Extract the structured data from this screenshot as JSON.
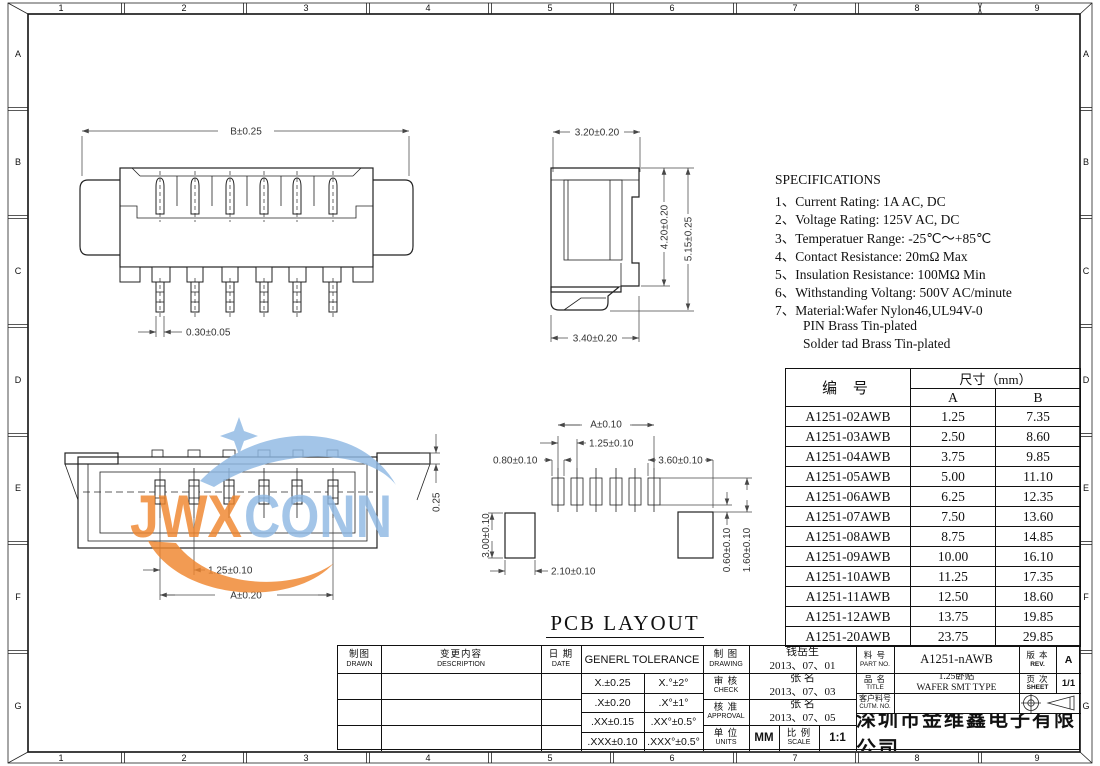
{
  "frame": {
    "top_zones": [
      "1",
      "2",
      "3",
      "4",
      "5",
      "6",
      "7",
      "8",
      "9"
    ],
    "bottom_zones": [
      "1",
      "2",
      "3",
      "4",
      "5",
      "6",
      "7",
      "8",
      "9"
    ],
    "left_zones": [
      "A",
      "B",
      "C",
      "D",
      "E",
      "F",
      "G"
    ],
    "right_zones": [
      "A",
      "B",
      "C",
      "D",
      "E",
      "F",
      "G"
    ]
  },
  "watermark": {
    "jwx": "JWX",
    "conn": "CONN",
    "orange": "#F0862E",
    "blue": "#8FB9E4"
  },
  "front_view": {
    "dim_width": "B±0.25",
    "dim_pin": "0.30±0.05"
  },
  "side_view": {
    "dim_top": "3.20±0.20",
    "dim_height_inner": "4.20±0.20",
    "dim_height_outer": "5.15±0.25",
    "dim_bottom": "3.40±0.20"
  },
  "top_view": {
    "dim_pitch": "1.25±0.10",
    "dim_span": "A±0.20",
    "dim_lug": "0.25"
  },
  "pcb_layout": {
    "title": "PCB LAYOUT",
    "dim_span": "A±0.10",
    "dim_pitch": "1.25±0.10",
    "dim_pad_width": "0.80±0.10",
    "dim_side": "3.60±0.10",
    "dim_pad_height": "3.00±0.10",
    "dim_pad_width2": "2.10±0.10",
    "dim_gap": "0.60±0.10",
    "dim_offset": "1.60±0.10"
  },
  "specifications": {
    "title": "SPECIFICATIONS",
    "lines": [
      "1、Current Rating: 1A AC, DC",
      "2、Voltage Rating: 125V AC, DC",
      "3、Temperatuer Range: -25℃～+85℃",
      "4、Contact Resistance: 20mΩ Max",
      "5、Insulation Resistance: 100MΩ Min",
      "6、Withstanding Voltang: 500V AC/minute",
      "7、Material:Wafer Nylon46,UL94V-0",
      "PIN Brass Tin-plated",
      "Solder tad Brass Tin-plated"
    ]
  },
  "part_table": {
    "header_part_no": "编  号",
    "header_dim": "尺寸（mm）",
    "header_a": "A",
    "header_b": "B",
    "rows": [
      [
        "A1251-02AWB",
        "1.25",
        "7.35"
      ],
      [
        "A1251-03AWB",
        "2.50",
        "8.60"
      ],
      [
        "A1251-04AWB",
        "3.75",
        "9.85"
      ],
      [
        "A1251-05AWB",
        "5.00",
        "11.10"
      ],
      [
        "A1251-06AWB",
        "6.25",
        "12.35"
      ],
      [
        "A1251-07AWB",
        "7.50",
        "13.60"
      ],
      [
        "A1251-08AWB",
        "8.75",
        "14.85"
      ],
      [
        "A1251-09AWB",
        "10.00",
        "16.10"
      ],
      [
        "A1251-10AWB",
        "11.25",
        "17.35"
      ],
      [
        "A1251-11AWB",
        "12.50",
        "18.60"
      ],
      [
        "A1251-12AWB",
        "13.75",
        "19.85"
      ],
      [
        "A1251-20AWB",
        "23.75",
        "29.85"
      ]
    ]
  },
  "title_block": {
    "drawn_cn": "制图",
    "drawn_en": "DRAWN",
    "description_cn": "变更内容",
    "description_en": "DESCRIPTION",
    "date_cn": "日 期",
    "date_en": "DATE",
    "tolerance_title": "GENERL TOLERANCE",
    "tolerances": [
      [
        "X.±0.25",
        "X.°±2°"
      ],
      [
        ".X±0.20",
        ".X°±1°"
      ],
      [
        ".XX±0.15",
        ".XX°±0.5°"
      ],
      [
        ".XXX±0.10",
        ".XXX°±0.5°"
      ]
    ],
    "drawing_cn": "制 图",
    "drawing_en": "DRAWING",
    "drawing_name": "钱岳生",
    "drawing_date": "2013、07、01",
    "check_cn": "审 核",
    "check_en": "CHECK",
    "check_name": "张 名",
    "check_date": "2013、07、03",
    "approval_cn": "核 准",
    "approval_en": "APPROVAL",
    "approval_name": "张 名",
    "approval_date": "2013、07、05",
    "units_cn": "单 位",
    "units_en": "UNITS",
    "units_value": "MM",
    "scale_cn": "比 例",
    "scale_en": "SCALE",
    "scale_value": "1:1",
    "part_no_cn": "料 号",
    "part_no_en": "PART NO.",
    "part_no_value": "A1251-nAWB",
    "rev_cn": "版 本",
    "rev_en": "REV.",
    "rev_value": "A",
    "product_cn": "品 名",
    "product_en": "TITLE",
    "product_value_line1": "1.25卧贴",
    "product_value_line2": "WAFER SMT TYPE",
    "sheet_cn": "页 次",
    "sheet_en": "SHEET",
    "sheet_value": "1/1",
    "customer_cn": "客户料号",
    "customer_en": "CUTM. NO.",
    "company": "深圳市金维鑫电子有限公司"
  }
}
